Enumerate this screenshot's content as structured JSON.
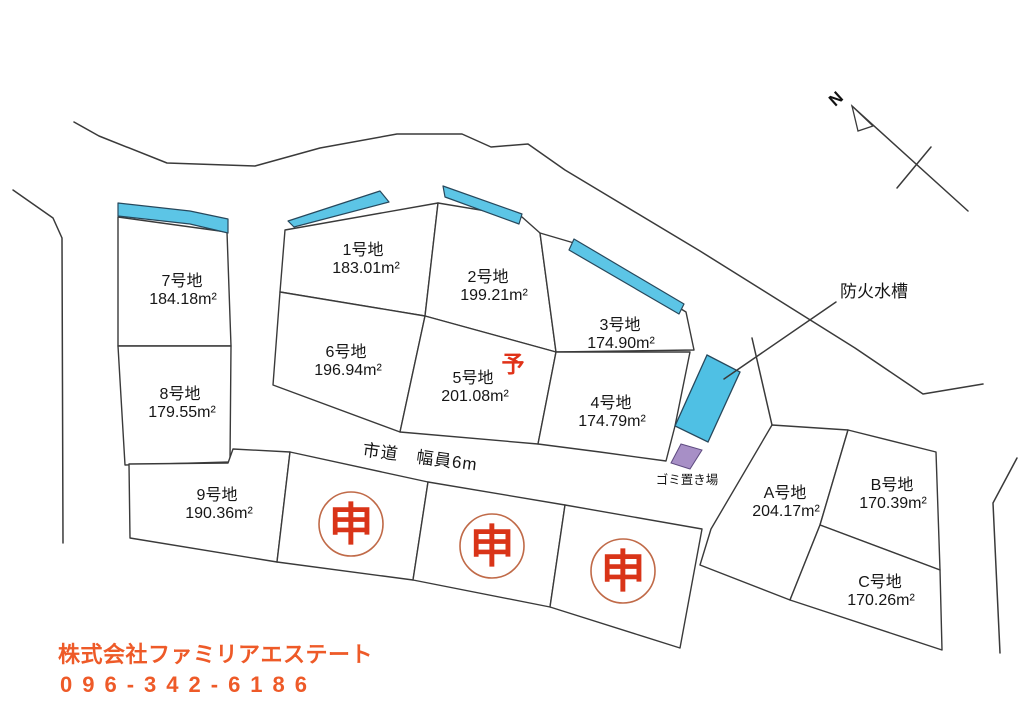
{
  "compass": {
    "north_label": "N"
  },
  "road": {
    "label": "市道　幅員6m"
  },
  "landmarks": {
    "fire_tank_label": "防火水槽",
    "garbage_label": "ゴミ置き場"
  },
  "marks": {
    "reserved": "予",
    "applied": "申"
  },
  "lots": [
    {
      "id": "1",
      "name": "1号地",
      "area": "183.01m²"
    },
    {
      "id": "2",
      "name": "2号地",
      "area": "199.21m²"
    },
    {
      "id": "3",
      "name": "3号地",
      "area": "174.90m²"
    },
    {
      "id": "4",
      "name": "4号地",
      "area": "174.79m²"
    },
    {
      "id": "5",
      "name": "5号地",
      "area": "201.08m²"
    },
    {
      "id": "6",
      "name": "6号地",
      "area": "196.94m²"
    },
    {
      "id": "7",
      "name": "7号地",
      "area": "184.18m²"
    },
    {
      "id": "8",
      "name": "8号地",
      "area": "179.55m²"
    },
    {
      "id": "9",
      "name": "9号地",
      "area": "190.36m²"
    },
    {
      "id": "A",
      "name": "A号地",
      "area": "204.17m²"
    },
    {
      "id": "B",
      "name": "B号地",
      "area": "170.39m²"
    },
    {
      "id": "C",
      "name": "C号地",
      "area": "170.26m²"
    }
  ],
  "footer": {
    "company": "株式会社ファミリアエステート",
    "phone": "096-342-6186"
  },
  "colors": {
    "frontage_highlight": "#5cc5e6",
    "fire_tank": "#4fc0e4",
    "garbage_area": "#a78fc6",
    "reserved_red": "#e03218",
    "applied_red": "#d93418",
    "footer_orange": "#ee5a28",
    "line": "#3a3a3a"
  }
}
